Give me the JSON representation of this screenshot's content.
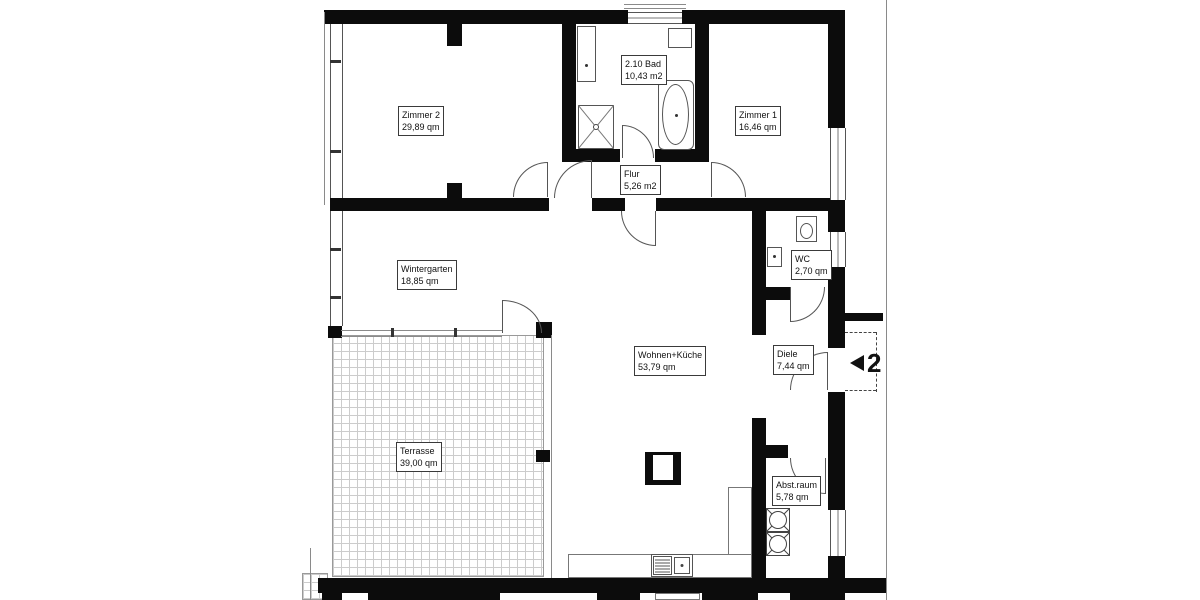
{
  "plan": {
    "title": "Wohnung 2 Grundriss",
    "unit": {
      "marker_number": "2"
    },
    "rooms": {
      "zimmer2": {
        "name": "Zimmer 2",
        "area": "29,89 qm"
      },
      "bad": {
        "name": "2.10 Bad",
        "area": "10,43 m2"
      },
      "zimmer1": {
        "name": "Zimmer 1",
        "area": "16,46 qm"
      },
      "flur": {
        "name": "Flur",
        "area": "5,26 m2"
      },
      "wintergarten": {
        "name": "Wintergarten",
        "area": "18,85 qm"
      },
      "wc": {
        "name": "WC",
        "area": "2,70 qm"
      },
      "wohnen_kueche": {
        "name": "Wohnen+Küche",
        "area": "53,79 qm"
      },
      "diele": {
        "name": "Diele",
        "area": "7,44 qm"
      },
      "terrasse": {
        "name": "Terrasse",
        "area": "39,00 qm"
      },
      "abstellraum": {
        "name": "Abst.raum",
        "area": "5,78 qm"
      }
    },
    "colors": {
      "wall": "#0c0c0c",
      "line": "#555555",
      "hatch": "#cccccc"
    }
  }
}
